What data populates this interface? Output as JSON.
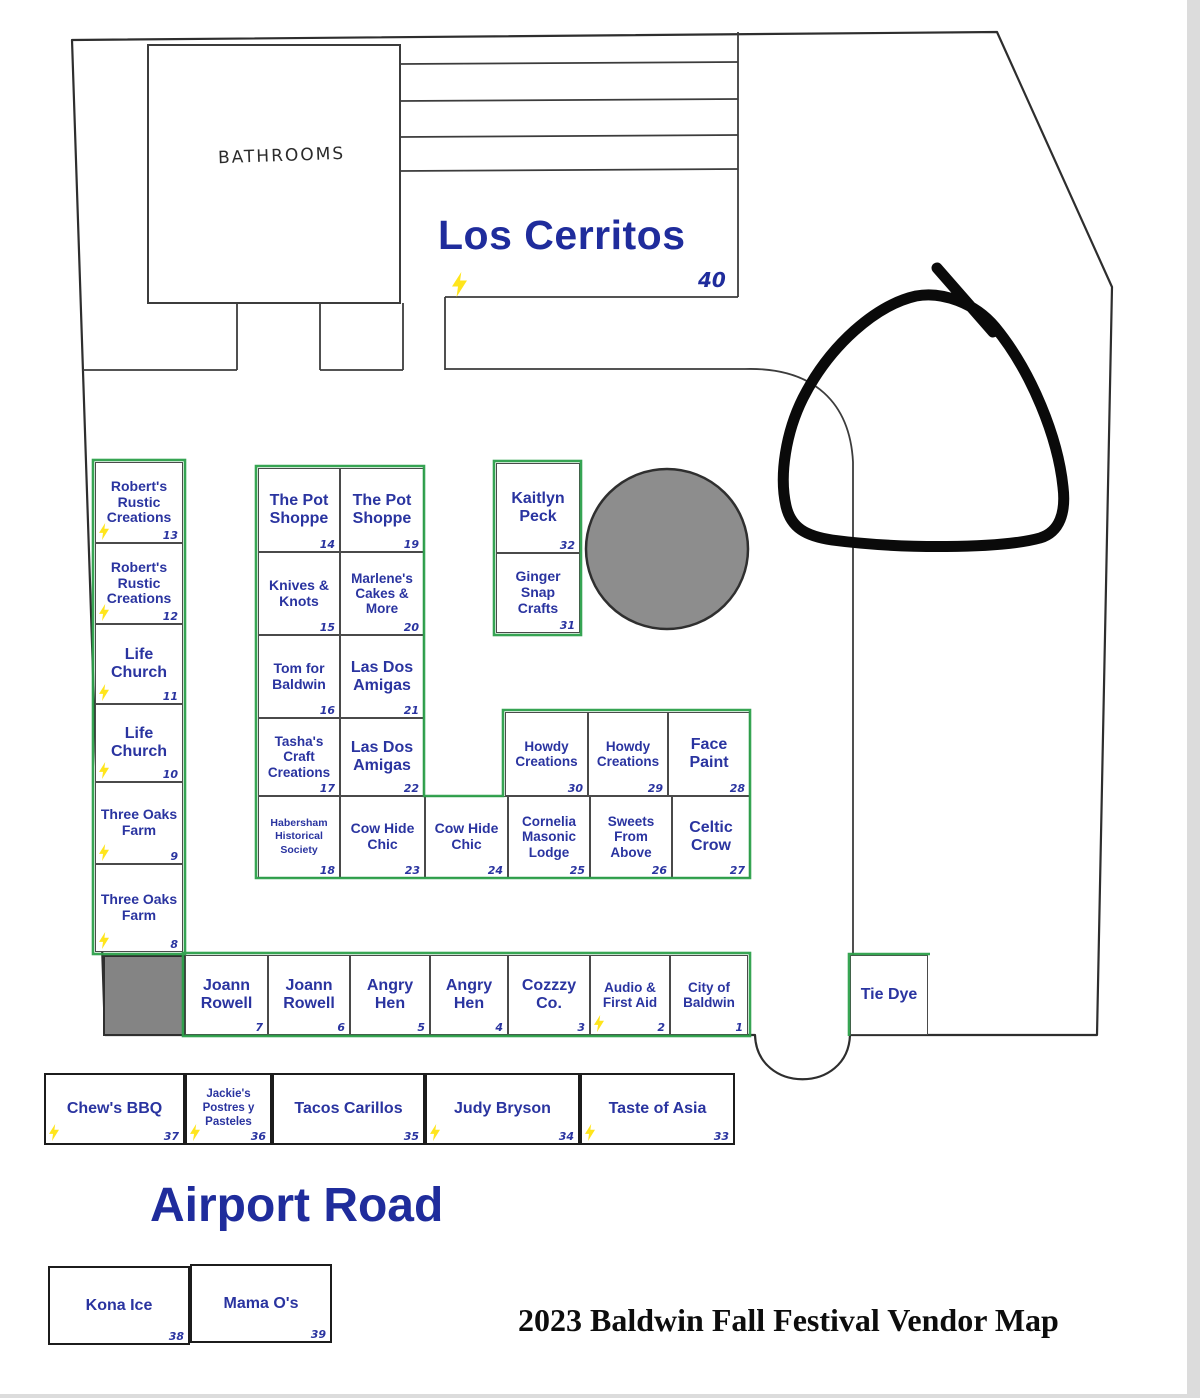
{
  "labels": {
    "bathrooms": "BATHROOMS",
    "los_cerritos_name": "Los Cerritos",
    "los_cerritos_number": "40",
    "airport_road": "Airport Road",
    "title": "2023 Baldwin Fall Festival Vendor Map"
  },
  "colors": {
    "booth_text": "#2a34a0",
    "green_outline": "#2ca04a",
    "line": "#3c3c3c",
    "gray_fill": "#8d8d8d",
    "bolt_yellow": "#ffe51c"
  },
  "icons": {
    "power": "lightning-bolt-icon"
  },
  "booths": {
    "left_column": [
      {
        "name": "Robert's Rustic Creations",
        "number": "13"
      },
      {
        "name": "Robert's Rustic Creations",
        "number": "12"
      },
      {
        "name": "Life Church",
        "number": "11"
      },
      {
        "name": "Life Church",
        "number": "10"
      },
      {
        "name": "Three Oaks Farm",
        "number": "9"
      },
      {
        "name": "Three Oaks Farm",
        "number": "8"
      }
    ],
    "mid_col_a": [
      {
        "name": "The Pot Shoppe",
        "number": "14"
      },
      {
        "name": "Knives & Knots",
        "number": "15"
      },
      {
        "name": "Tom for Baldwin",
        "number": "16"
      },
      {
        "name": "Tasha's Craft Creations",
        "number": "17"
      }
    ],
    "mid_col_b": [
      {
        "name": "The Pot Shoppe",
        "number": "19"
      },
      {
        "name": "Marlene's Cakes & More",
        "number": "20"
      },
      {
        "name": "Las Dos Amigas",
        "number": "21"
      },
      {
        "name": "Las Dos Amigas",
        "number": "22"
      }
    ],
    "mid_bottom_row": [
      {
        "name": "Habersham Historical Society",
        "number": "18"
      },
      {
        "name": "Cow Hide Chic",
        "number": "23"
      },
      {
        "name": "Cow Hide Chic",
        "number": "24"
      },
      {
        "name": "Cornelia Masonic Lodge",
        "number": "25"
      },
      {
        "name": "Sweets From Above",
        "number": "26"
      },
      {
        "name": "Celtic Crow",
        "number": "27"
      }
    ],
    "howdy_row": [
      {
        "name": "Howdy Creations",
        "number": "30"
      },
      {
        "name": "Howdy Creations",
        "number": "29"
      },
      {
        "name": "Face Paint",
        "number": "28"
      }
    ],
    "kaitlyn_col": [
      {
        "name": "Kaitlyn Peck",
        "number": "32"
      },
      {
        "name": "Ginger Snap Crafts",
        "number": "31"
      }
    ],
    "vendor_row": [
      {
        "name": "Joann Rowell",
        "number": "7"
      },
      {
        "name": "Joann Rowell",
        "number": "6"
      },
      {
        "name": "Angry Hen",
        "number": "5"
      },
      {
        "name": "Angry Hen",
        "number": "4"
      },
      {
        "name": "Cozzzy Co.",
        "number": "3"
      },
      {
        "name": "Audio & First Aid",
        "number": "2"
      },
      {
        "name": "City of Baldwin",
        "number": "1"
      }
    ],
    "tie_dye": {
      "name": "Tie Dye"
    },
    "food_row": [
      {
        "name": "Chew's BBQ",
        "number": "37"
      },
      {
        "name": "Jackie's Postres y Pasteles",
        "number": "36"
      },
      {
        "name": "Tacos Carillos",
        "number": "35"
      },
      {
        "name": "Judy Bryson",
        "number": "34"
      },
      {
        "name": "Taste of Asia",
        "number": "33"
      }
    ],
    "kona_row": [
      {
        "name": "Kona Ice",
        "number": "38"
      },
      {
        "name": "Mama O's",
        "number": "39"
      }
    ]
  }
}
